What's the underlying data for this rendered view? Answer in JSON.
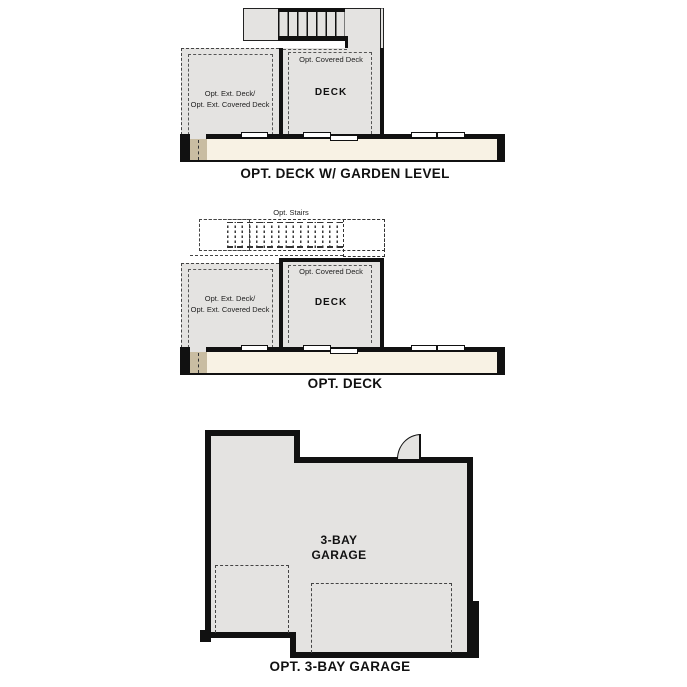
{
  "colors": {
    "plan_fill": "#e4e3e1",
    "band_fill": "#f8f2e4",
    "accent_tan": "#c9bda2",
    "wall": "#111111"
  },
  "sections": {
    "deck_garden": {
      "caption": "OPT. DECK W/ GARDEN LEVEL",
      "deck_room": "DECK",
      "covered_deck": "Opt. Covered Deck",
      "ext_deck_line1": "Opt. Ext. Deck/",
      "ext_deck_line2": "Opt. Ext. Covered Deck"
    },
    "deck": {
      "caption": "OPT. DECK",
      "stairs": "Opt. Stairs",
      "deck_room": "DECK",
      "covered_deck": "Opt. Covered Deck",
      "ext_deck_line1": "Opt. Ext. Deck/",
      "ext_deck_line2": "Opt. Ext. Covered Deck"
    },
    "garage": {
      "caption": "OPT. 3-BAY GARAGE",
      "room_line1": "3-BAY",
      "room_line2": "GARAGE"
    }
  }
}
